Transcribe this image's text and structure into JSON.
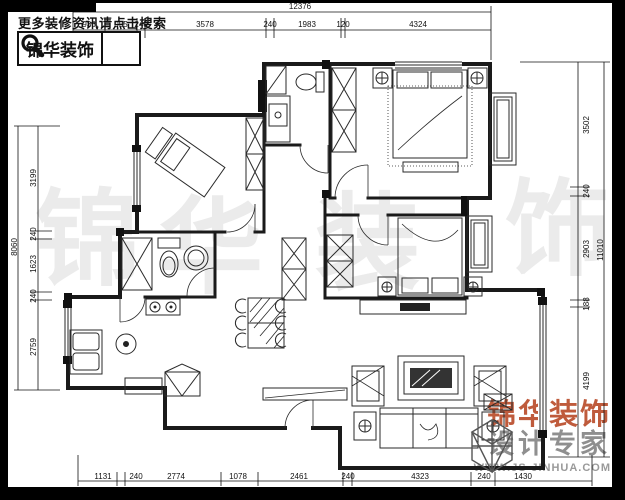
{
  "header": {
    "promo_text": "更多装修资讯请点击搜索",
    "logo_text": "锦华装饰"
  },
  "watermark_chars": [
    "锦",
    "华",
    "装",
    "饰"
  ],
  "brand_block": {
    "line1": "锦华装饰",
    "line2": "设计专家",
    "url": "WWW.JS-JINHUA.COM"
  },
  "dimensions": {
    "top": {
      "total": "12376",
      "segments": [
        "936",
        "955",
        "240",
        "3578",
        "240",
        "1983",
        "120",
        "4324"
      ]
    },
    "bottom": {
      "total": "13917",
      "segments": [
        "1131",
        "240",
        "2774",
        "1078",
        "2461",
        "240",
        "4323",
        "240",
        "1430"
      ]
    },
    "left": {
      "total": "8060",
      "segments": [
        "3199",
        "240",
        "1623",
        "240",
        "2759"
      ]
    },
    "right": {
      "total": "11010",
      "segments": [
        "3502",
        "240",
        "2903",
        "188",
        "4199"
      ]
    }
  },
  "colors": {
    "brand_orange": "#bf5b3c",
    "watermark_gray": "#ebebeb",
    "line_black": "#1a1a1a"
  }
}
